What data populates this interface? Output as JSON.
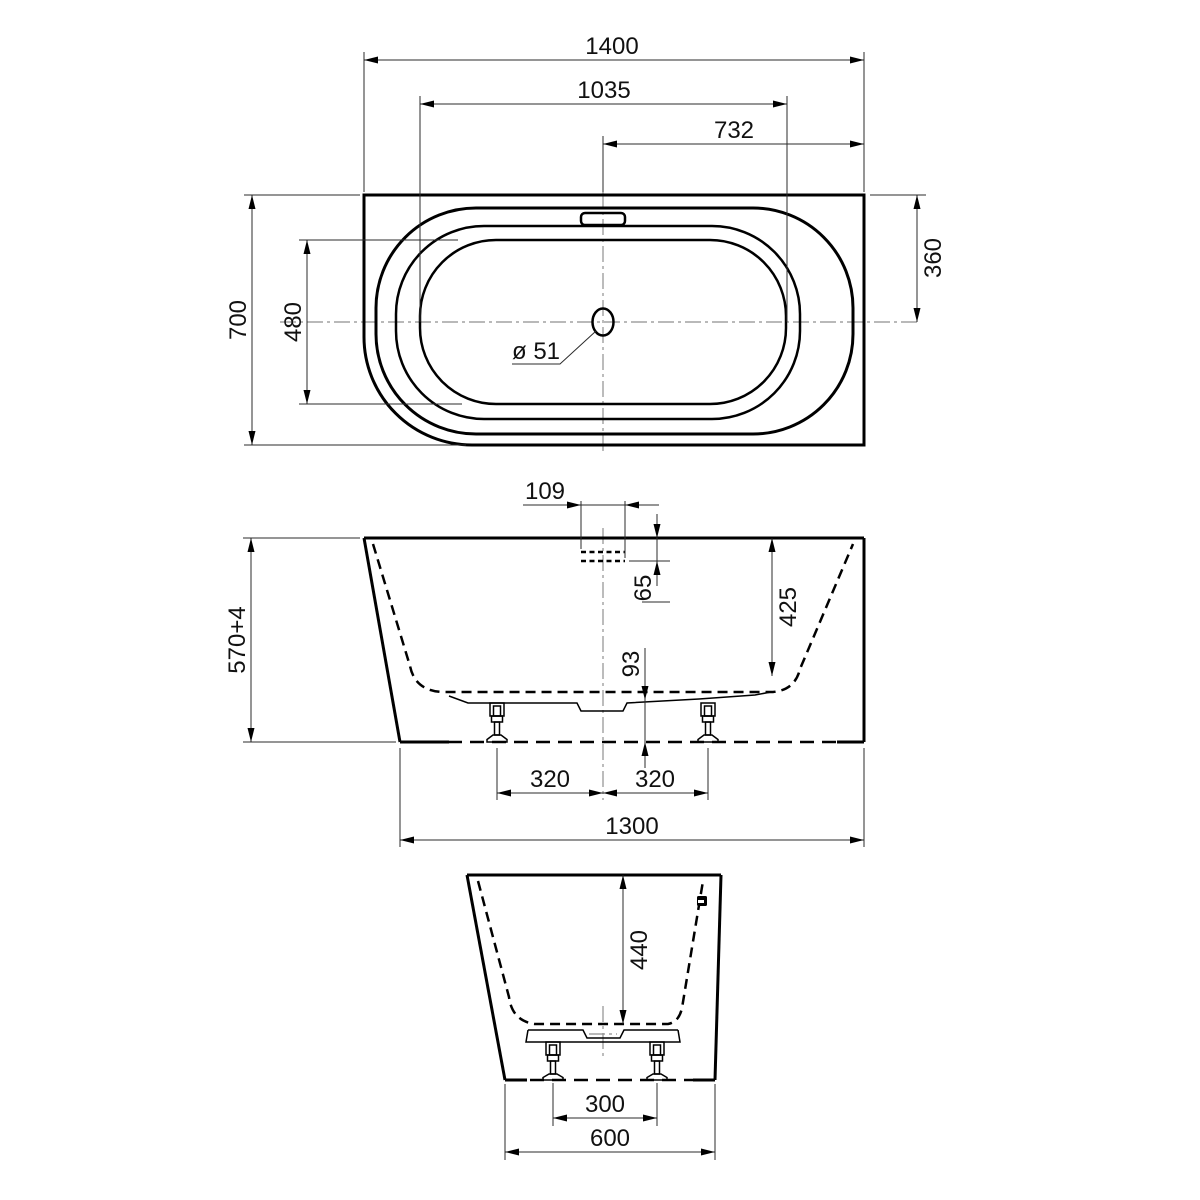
{
  "drawing": {
    "background": "#ffffff",
    "line_color": "#000000",
    "centerline_color": "#8f8f8f",
    "top_view": {
      "overall_length": "1400",
      "basin_length": "1035",
      "center_to_right_edge": "732",
      "overall_width": "700",
      "basin_width": "480",
      "top_edge_to_center": "360",
      "drain_diameter": "ø 51"
    },
    "front_view": {
      "overflow_slot_width": "109",
      "overflow_slot_depth": "65",
      "inner_depth": "425",
      "underbody_clearance": "93",
      "overall_height": "570+4",
      "center_to_left_foot": "320",
      "center_to_right_foot": "320",
      "base_length": "1300"
    },
    "side_view": {
      "inner_depth": "440",
      "foot_spacing": "300",
      "base_width": "600"
    }
  }
}
